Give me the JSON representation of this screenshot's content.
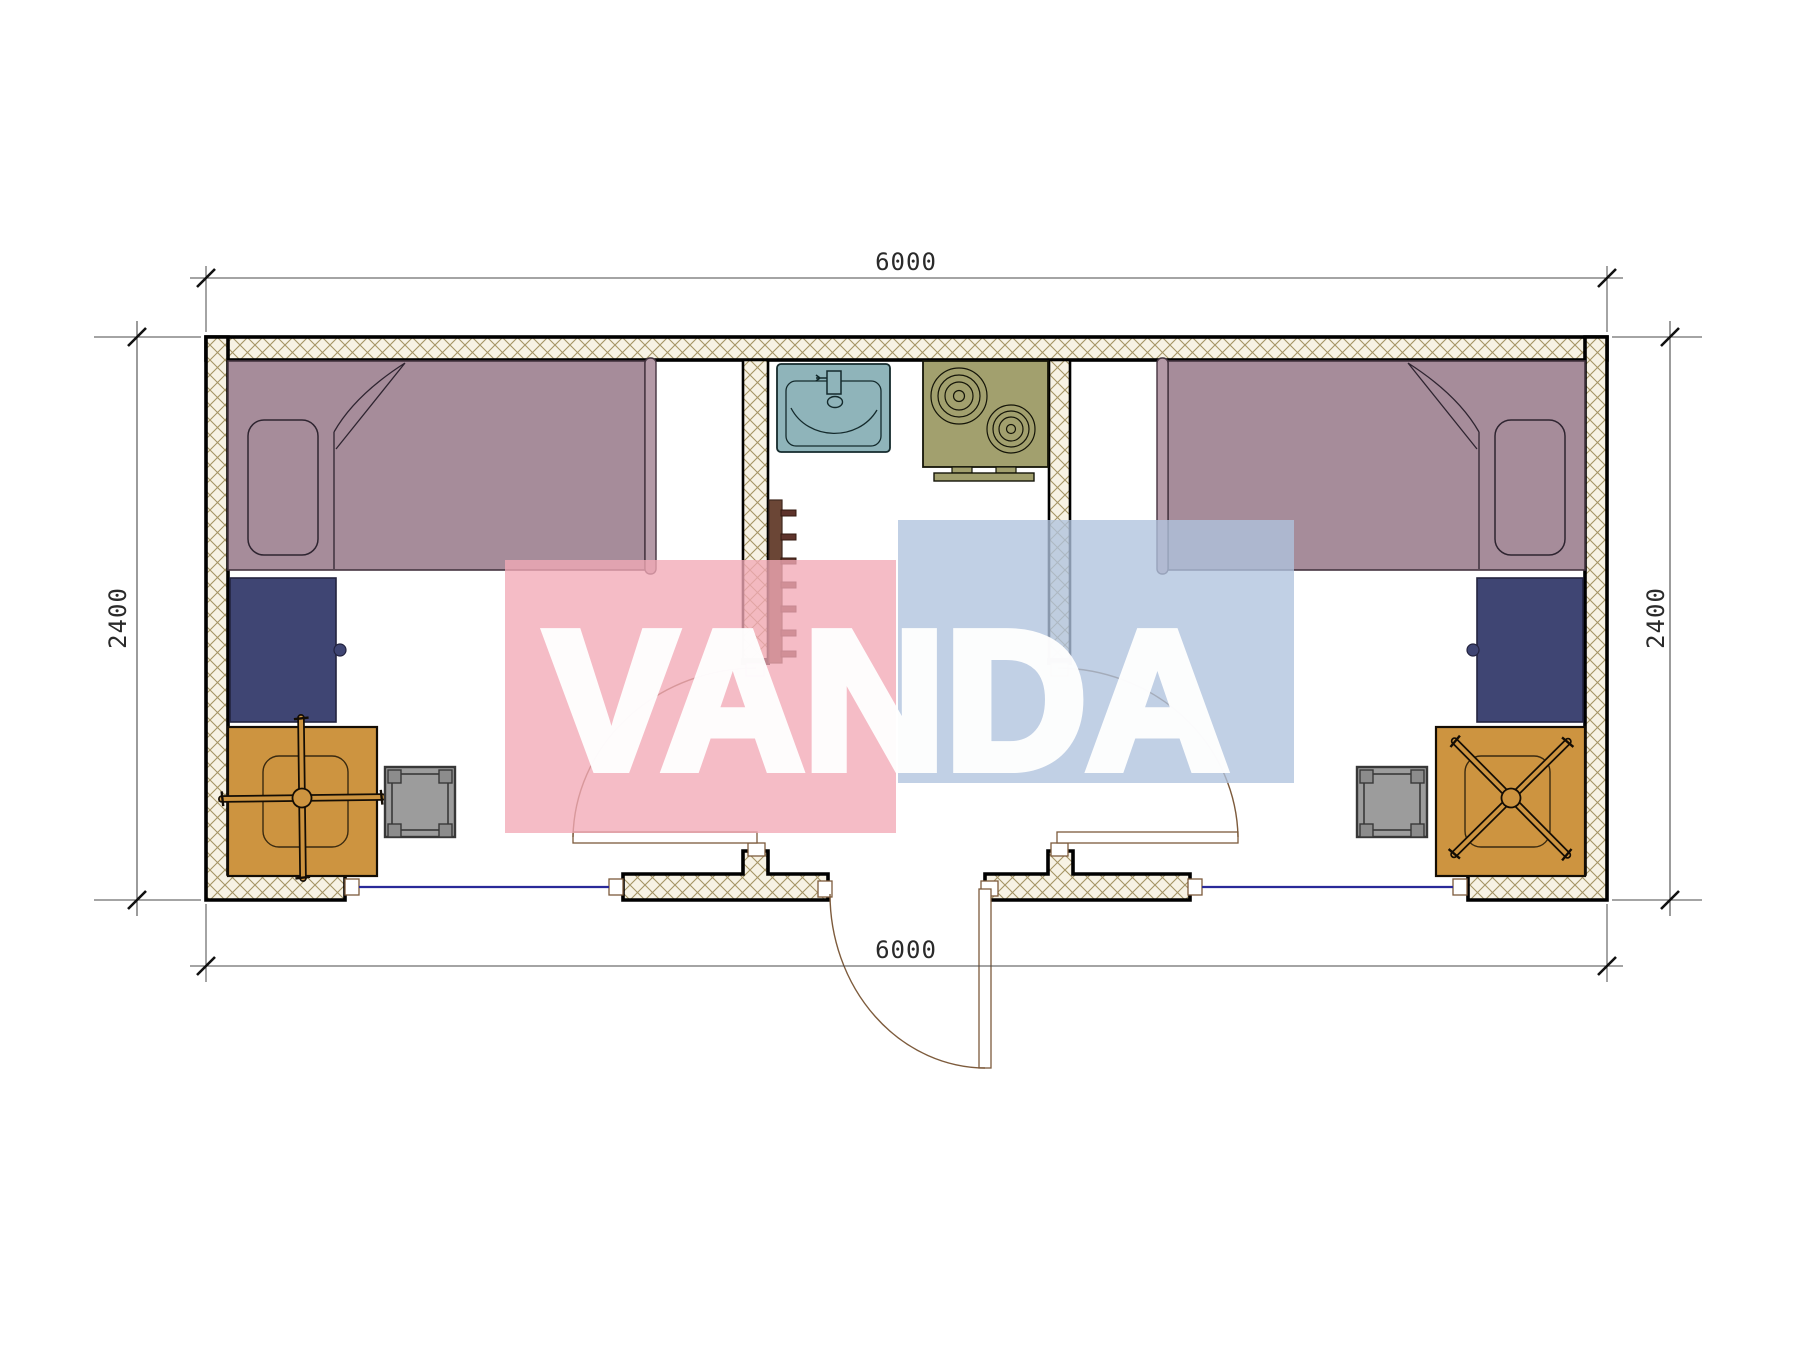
{
  "dimensions": {
    "top": "6000",
    "bottom": "6000",
    "left": "2400",
    "right": "2400"
  },
  "watermark": {
    "text": "VANDA",
    "pink": "#f2a9b6",
    "blue": "#afc3de",
    "text_color": "#ffffff"
  },
  "colors": {
    "page_bg": "#ffffff",
    "wall_fill": "#f7f2e4",
    "wall_hatch_line": "#a59464",
    "wall_border": "#000000",
    "bed": "#a68c9a",
    "bed_footboard": "#b49aa7",
    "nightstand_navy": "#3f4573",
    "desk_orange": "#cd9440",
    "stool_gray": "#9c9c9c",
    "sink_teal": "#8fb4ba",
    "stove_olive": "#a2a06e",
    "towel_rail_brown": "#6b4636",
    "window_glazing_blue": "#2a2a99",
    "door_swing_tan": "#7d5b3c",
    "dimension_text": "#2a2a2a"
  }
}
